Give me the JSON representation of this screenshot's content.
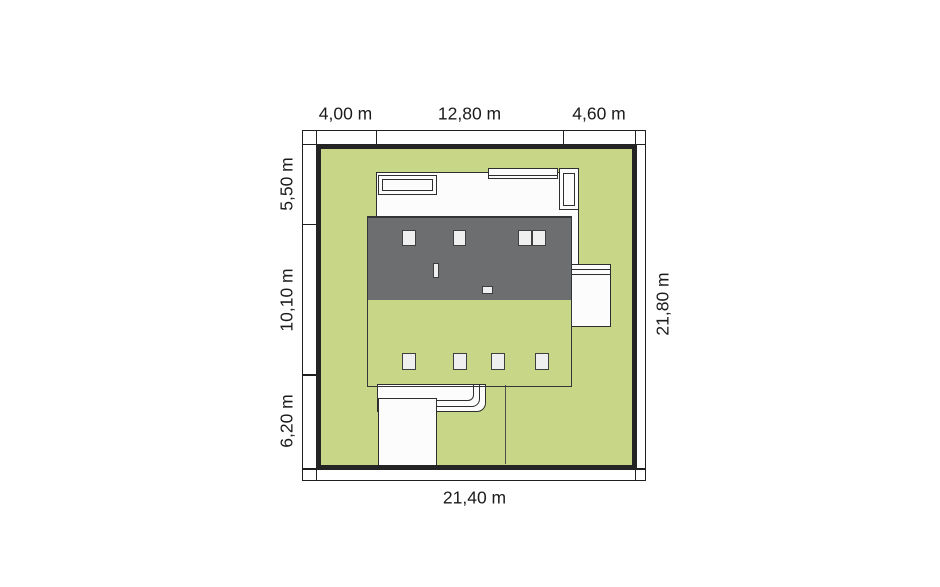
{
  "figure": {
    "type": "architectural-site-plan",
    "description": "Top-down plot plan of a single-family house on a green lot with dimension bands"
  },
  "dimensions": {
    "top": [
      "4,00 m",
      "12,80 m",
      "4,60 m"
    ],
    "left": [
      "5,50 m",
      "10,10 m",
      "6,20 m"
    ],
    "right": [
      "21,80 m"
    ],
    "bottom": [
      "21,40 m"
    ]
  },
  "colors": {
    "plot_green": "#c7d787",
    "roof_dark": "#6c6e70",
    "roof_light": "#b3b5b4",
    "paving_white": "#fcfcfc",
    "outline": "#2e2e2e",
    "text": "#1b1b1b"
  }
}
